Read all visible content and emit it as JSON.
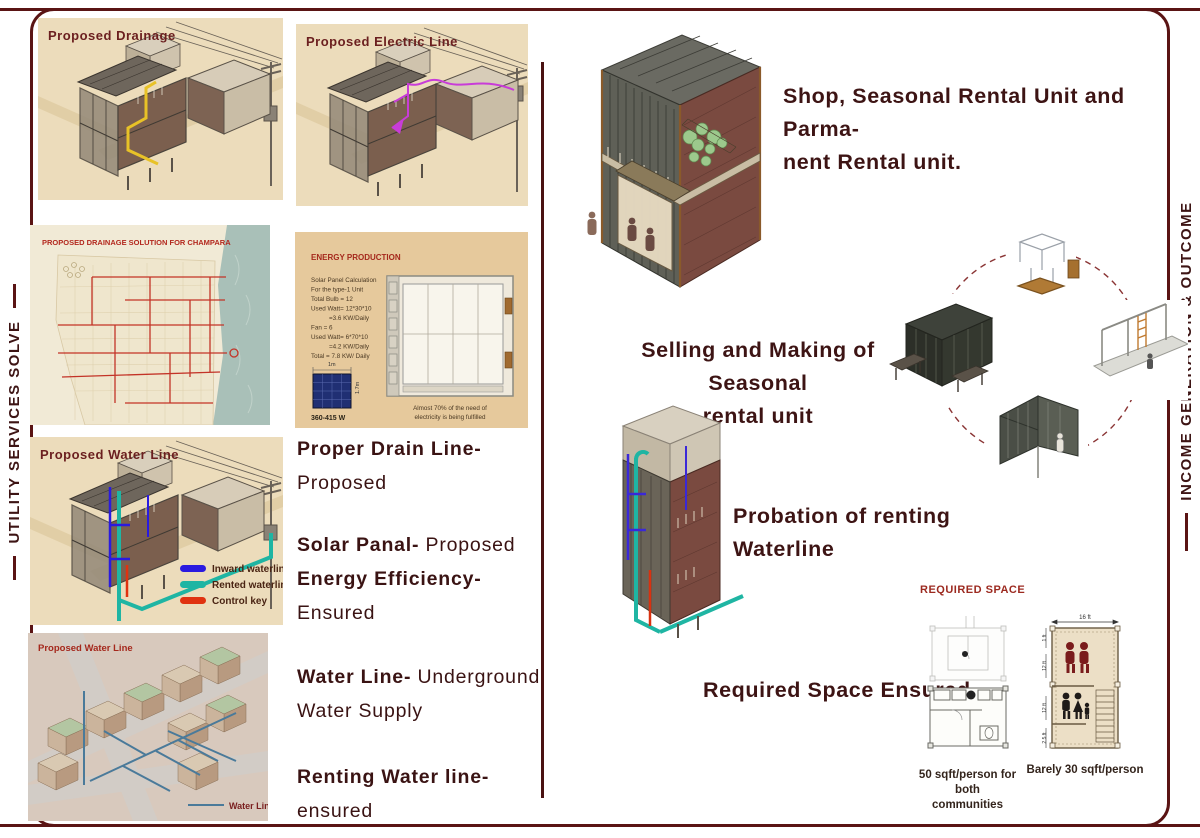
{
  "rails": {
    "left": "UTILITY SERVICES SOLVE",
    "right": "INCOME GENERATION & OUTCOME"
  },
  "panels": {
    "drainage": {
      "title": "Proposed Drainage"
    },
    "electric": {
      "title": "Proposed Electric Line"
    },
    "drainage_map": {
      "title": "PROPOSED DRAINAGE SOLUTION FOR CHAMPARA"
    },
    "energy": {
      "title": "ENERGY PRODUCTION",
      "calc": [
        "Solar Panel Calculation",
        "For the type-1 Unit",
        "Total Bulb = 12",
        "Used Watt= 12*30*10",
        "=3.6 KW/Daily",
        "Fan = 6",
        "Used Watt= 6*70*10",
        "=4.2 KW/Daily",
        "Total = 7.8 KW/ Daily"
      ],
      "panel_width": "1m",
      "panel_height": "1.7m",
      "panel_rating": "360-415 W",
      "caption1": "Almost 70% of the need of",
      "caption2": "electricity is being fulfilled"
    },
    "water": {
      "title": "Proposed Water Line",
      "legend": [
        {
          "label": "Inward waterline",
          "color": "#2a1ae0"
        },
        {
          "label": "Rented waterline",
          "color": "#1fb5a3"
        },
        {
          "label": "Control key",
          "color": "#e03210"
        }
      ]
    },
    "water_map": {
      "title": "Proposed Water Line",
      "legend_label": "Water Line"
    }
  },
  "notes": {
    "n1b": "Proper Drain Line-",
    "n1r": "Proposed",
    "n2b": "Solar Panal-",
    "n2r": "Proposed",
    "n2b2": "Energy Efficiency-",
    "n2r2": "Ensured",
    "n3b": "Water Line-",
    "n3r": "Underground",
    "n3r2": "Water Supply",
    "n4b": "Renting Water line-",
    "n4r": "ensured"
  },
  "right": {
    "shop1": "Shop, Seasonal Rental Unit and Parma-",
    "shop2": "nent Rental  unit.",
    "selling1": "Selling and Making of Seasonal",
    "selling2": "rental unit",
    "probation": "Probation of renting Waterline",
    "ensured": "Required Space Ensured",
    "required_space": {
      "title": "REQUIRED SPACE",
      "cap_left1": "50 sqft/person for both",
      "cap_left2": "communities",
      "cap_right": "Barely 30 sqft/person",
      "dim_top": "16 ft",
      "dims": [
        "1 ft",
        "12 ft",
        "12 ft",
        "2.5 ft"
      ]
    }
  }
}
